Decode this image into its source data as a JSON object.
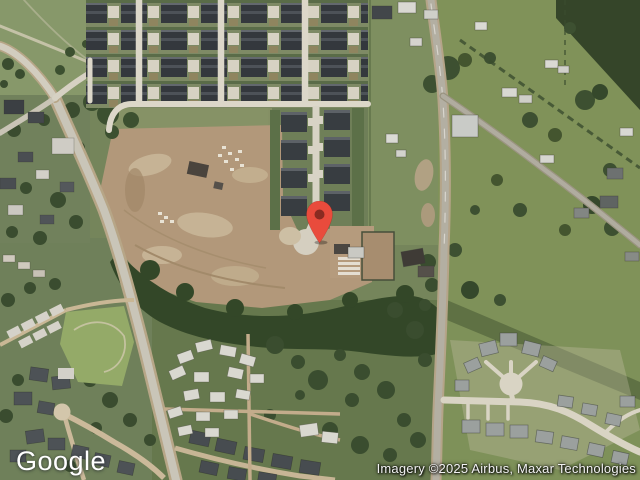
{
  "map": {
    "view_type": "satellite",
    "logo_text": "Google",
    "attribution_text": "Imagery ©2025 Airbus, Maxar Technologies",
    "marker": {
      "x": 319,
      "y": 243,
      "body_color": "#E94B3C",
      "dot_color": "#8A2B21"
    },
    "palette": {
      "field_green": "#7E8F60",
      "dark_trees": "#35482B",
      "dirt_field": "#B2987A",
      "road_gray": "#B3AFA2",
      "street_light": "#DCD7C9",
      "roof_dark": "#34383D",
      "roof_light": "#D9D8D0"
    }
  }
}
